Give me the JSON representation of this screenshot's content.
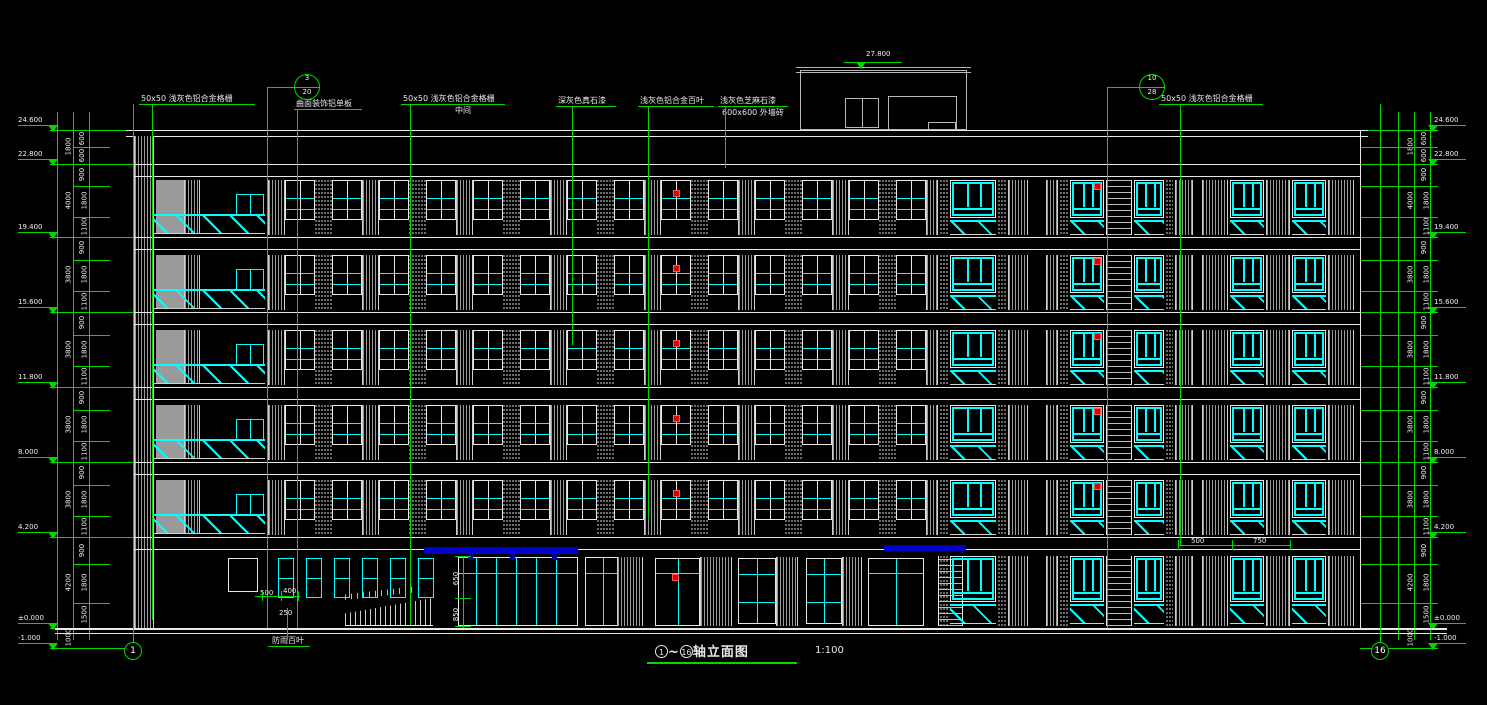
{
  "title": {
    "axis_start": "1",
    "axis_end": "16",
    "text": "轴立面图",
    "scale": "1:100"
  },
  "colors": {
    "background": "#000000",
    "line": "#e8e8e8",
    "dimension": "#00d900",
    "glass": "#00ffff",
    "canopy": "#0000cc",
    "panel": "#9a9a9a",
    "marker": "#dd0000"
  },
  "top_labels": [
    {
      "text": "50x50  浅灰色铝合金格栅",
      "x": 141,
      "y": 102,
      "w": 114,
      "leader_x": 152,
      "leader_y2": 620
    },
    {
      "text": "曲面装饰铝单板",
      "x": 296,
      "y": 107,
      "w": 66,
      "leader_x": 297,
      "leader_y2": 628
    },
    {
      "text": "50x50  浅灰色铝合金格栅",
      "x": 403,
      "y": 102,
      "w": 102,
      "sub": "中间",
      "sub_x": 455,
      "leader_x": 410,
      "leader_y2": 625
    },
    {
      "text": "深灰色真石漆",
      "x": 558,
      "y": 104,
      "w": 58,
      "leader_x": 572,
      "leader_y2": 345
    },
    {
      "text": "浅灰色铝合金百叶",
      "x": 640,
      "y": 104,
      "w": 74,
      "leader_x": 648,
      "leader_y2": 520
    },
    {
      "text": "浅灰色芝麻石漆",
      "x": 720,
      "y": 104,
      "w": 68,
      "sub": "600x600 外墙砖",
      "sub_x": 722,
      "leader_x": 725,
      "leader_y2": 168
    },
    {
      "text": "50x50  浅灰色铝合金格栅",
      "x": 1161,
      "y": 102,
      "w": 102,
      "leader_x": 1180,
      "leader_y2": 545
    }
  ],
  "ground_label": {
    "text": "防雨百叶",
    "x": 272,
    "y": 636,
    "leader_x": 287,
    "leader_y1": 608,
    "leader_y2": 640
  },
  "detail_bubbles": [
    {
      "top": "3",
      "bottom": "20",
      "x": 307,
      "y": 87,
      "conn_x": 282
    },
    {
      "top": "10",
      "bottom": "28",
      "x": 1152,
      "y": 87,
      "conn_x": 1122
    }
  ],
  "axis_bubbles": [
    {
      "label": "1",
      "x": 133,
      "y": 651
    },
    {
      "label": "16",
      "x": 1380,
      "y": 651
    }
  ],
  "roof_marker": {
    "value": "27.800",
    "x": 866,
    "y": 51
  },
  "levels": [
    {
      "v": "24.600",
      "y": 130
    },
    {
      "v": "22.800",
      "y": 164
    },
    {
      "v": "19.400",
      "y": 237
    },
    {
      "v": "15.600",
      "y": 312
    },
    {
      "v": "11.800",
      "y": 387
    },
    {
      "v": "8.000",
      "y": 462
    },
    {
      "v": "4.200",
      "y": 537
    },
    {
      "v": "±0.000",
      "y": 628
    },
    {
      "v": "-1.000",
      "y": 648
    }
  ],
  "dims_outer": [
    "1800",
    "4000",
    "3800",
    "3800",
    "3800",
    "3800",
    "4200",
    "1000"
  ],
  "dims_inner_top": [
    "600",
    "600"
  ],
  "dims_inner_floor": [
    "900",
    "1800",
    "1100"
  ],
  "dims_inner_bottom": [
    "900",
    "1800",
    "1500"
  ],
  "small_dims": [
    {
      "v": "500",
      "x": 260,
      "y": 590
    },
    {
      "v": "400",
      "x": 283,
      "y": 588
    },
    {
      "v": "250",
      "x": 279,
      "y": 610
    },
    {
      "v": "650",
      "x": 450,
      "y": 575,
      "rot": true
    },
    {
      "v": "850",
      "x": 450,
      "y": 611,
      "rot": true
    },
    {
      "v": "500",
      "x": 1191,
      "y": 538
    },
    {
      "v": "750",
      "x": 1253,
      "y": 538
    }
  ],
  "building": {
    "left": 133,
    "right": 1360,
    "parapet_y": 130,
    "ground_y": 628,
    "tower_w": 20
  },
  "rows": {
    "tops": [
      178,
      253,
      328,
      403,
      478
    ],
    "slab_levels": [
      164,
      237,
      312,
      387,
      462,
      537
    ],
    "win_h": 40,
    "hatch_h": 17
  },
  "left_bay": {
    "panel_x": 156,
    "panel_w": 44,
    "win_x": 236,
    "win_w": 28,
    "balc_x": 153,
    "balc_w": 112
  },
  "middle": {
    "start": 268,
    "end": 938,
    "win_w": 30,
    "pier_w": 17,
    "red_index": 8
  },
  "right_cells": [
    {
      "x": 940,
      "w": 8,
      "t": "stip"
    },
    {
      "x": 950,
      "w": 46,
      "t": "winC"
    },
    {
      "x": 998,
      "w": 8,
      "t": "stip"
    },
    {
      "x": 1008,
      "w": 20,
      "t": "louver"
    },
    {
      "x": 1046,
      "w": 12,
      "t": "louver"
    },
    {
      "x": 1060,
      "w": 8,
      "t": "stip"
    },
    {
      "x": 1070,
      "w": 34,
      "t": "winC",
      "red": true
    },
    {
      "x": 1106,
      "w": 26,
      "t": "lad"
    },
    {
      "x": 1134,
      "w": 30,
      "t": "winC"
    },
    {
      "x": 1166,
      "w": 7,
      "t": "stip"
    },
    {
      "x": 1175,
      "w": 18,
      "t": "louver"
    },
    {
      "x": 1202,
      "w": 26,
      "t": "louver"
    },
    {
      "x": 1230,
      "w": 34,
      "t": "winC"
    },
    {
      "x": 1266,
      "w": 24,
      "t": "louver"
    },
    {
      "x": 1292,
      "w": 34,
      "t": "winC"
    },
    {
      "x": 1328,
      "w": 26,
      "t": "louver"
    }
  ],
  "ground": {
    "top": 554,
    "win_h": 46,
    "hatch_y": 604,
    "hatch_h": 20,
    "door_left": {
      "x": 228,
      "y": 558,
      "w": 30,
      "h": 34
    },
    "louver_windows": {
      "start": 278,
      "count": 6,
      "step": 28,
      "w": 16,
      "y": 558,
      "h": 40
    },
    "ramp": {
      "x": 345,
      "y": 598,
      "w": 88,
      "h": 28
    },
    "rail": {
      "x": 345,
      "y": 586,
      "w": 72,
      "h": 14
    },
    "storefront": [
      {
        "x": 458,
        "w": 120
      },
      {
        "x": 585,
        "w": 58
      }
    ],
    "louver_over": {
      "x": 617,
      "w": 26
    },
    "doors": [
      {
        "x": 655,
        "w": 45,
        "red": true
      },
      {
        "x": 868,
        "w": 56
      }
    ],
    "wins": [
      {
        "x": 738,
        "w": 38
      },
      {
        "x": 806,
        "w": 36
      }
    ],
    "piers": [
      {
        "x": 700,
        "w": 32
      },
      {
        "x": 776,
        "w": 22
      },
      {
        "x": 842,
        "w": 20
      }
    ],
    "ladder": {
      "x": 938,
      "w": 25
    }
  },
  "canopies": [
    {
      "x": 424,
      "y": 547,
      "w": 154,
      "h": 7
    },
    {
      "x": 884,
      "y": 545,
      "w": 82,
      "h": 6
    }
  ],
  "canopy_posts": [
    {
      "x": 468,
      "y": 554
    },
    {
      "x": 510,
      "y": 554
    },
    {
      "x": 552,
      "y": 554
    }
  ],
  "red_markers": {
    "mid_x": 673,
    "right_x": 1094,
    "ground": {
      "x": 672,
      "y": 574
    }
  },
  "penthouse": {
    "x": 800,
    "y": 70,
    "w": 167,
    "h": 60,
    "window": {
      "x": 845,
      "y": 98,
      "w": 34,
      "h": 30
    },
    "door": {
      "x": 888,
      "y": 96,
      "w": 69,
      "h": 34
    },
    "box": {
      "x": 928,
      "y": 122,
      "w": 28,
      "h": 8
    }
  }
}
